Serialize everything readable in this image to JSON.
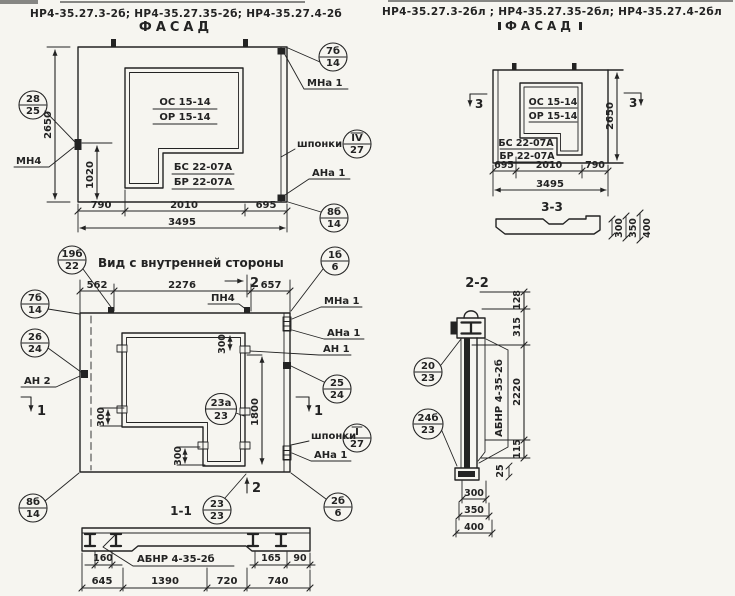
{
  "headerL": "НР4-35.27.3-2б;  НР4-35.27.35-2б;  НР4-35.27.4-2б",
  "headerR": "НР4-35.27.3-2бл ;  НР4-35.27.35-2бл;  НР4-35.27.4-2бл",
  "fL": {
    "title": "ФАСАД",
    "os": "ОС 15-14",
    "or": "ОР 15-14",
    "bs": "БС 22-07А",
    "br": "БР 22-07А",
    "mn4": "МН4",
    "mna1": "МНа 1",
    "shponki": "шпонки",
    "ana1": "АНа 1",
    "c1t": "28",
    "c1b": "25",
    "c2t": "7б",
    "c2b": "14",
    "c3t": "IV",
    "c3b": "27",
    "c4t": "8б",
    "c4b": "14",
    "d2650": "2650",
    "d1020": "1020",
    "d790": "790",
    "d2010": "2010",
    "d695": "695",
    "d3495": "3495"
  },
  "fR": {
    "title": "ФАСАД",
    "os": "ОС 15-14",
    "or": "ОР 15-14",
    "bs": "БС 22-07А",
    "br": "БР 22-07А",
    "sec": "3",
    "d2650": "2650",
    "d695": "695",
    "d2010": "2010",
    "d790": "790",
    "d3495": "3495",
    "s33": "3-3",
    "p300": "300",
    "p350": "350",
    "p400": "400"
  },
  "iv": {
    "title": "Вид с внутренней стороны",
    "pn4": "ПН4",
    "mna1": "МНа 1",
    "ana1": "АНа 1",
    "an1": "АН 1",
    "an2": "АН 2",
    "shponki": "шпонки",
    "ana1b": "АНа 1",
    "c19t": "19б",
    "c19b": "22",
    "c7t": "7б",
    "c7b": "14",
    "c26t": "26",
    "c26b": "24",
    "c1t": "1б",
    "c1b": "6",
    "c25t": "25",
    "c25b": "24",
    "c23at": "23а",
    "c23ab": "23",
    "cit": "I",
    "cib": "27",
    "c2t": "2б",
    "c2b": "6",
    "c23t": "23",
    "c23b": "23",
    "c8t": "8б",
    "c8b": "14",
    "d562": "562",
    "d2276": "2276",
    "d657": "657",
    "d300": "300",
    "d1800": "1800",
    "m1": "1",
    "m2": "2"
  },
  "s11": {
    "title": "1-1",
    "label": "АБНР 4-35-2б",
    "d160": "160",
    "d165": "165",
    "d90": "90",
    "d645": "645",
    "d1390": "1390",
    "d720": "720",
    "d740": "740"
  },
  "s22": {
    "title": "2-2",
    "label": "АБНР 4-35-2б",
    "c20t": "20",
    "c20b": "23",
    "c24t": "24б",
    "c24b": "23",
    "d128": "128",
    "d315": "315",
    "d2220": "2220",
    "d115": "115",
    "d25": "25",
    "d300": "300",
    "d350": "350",
    "d400": "400"
  }
}
